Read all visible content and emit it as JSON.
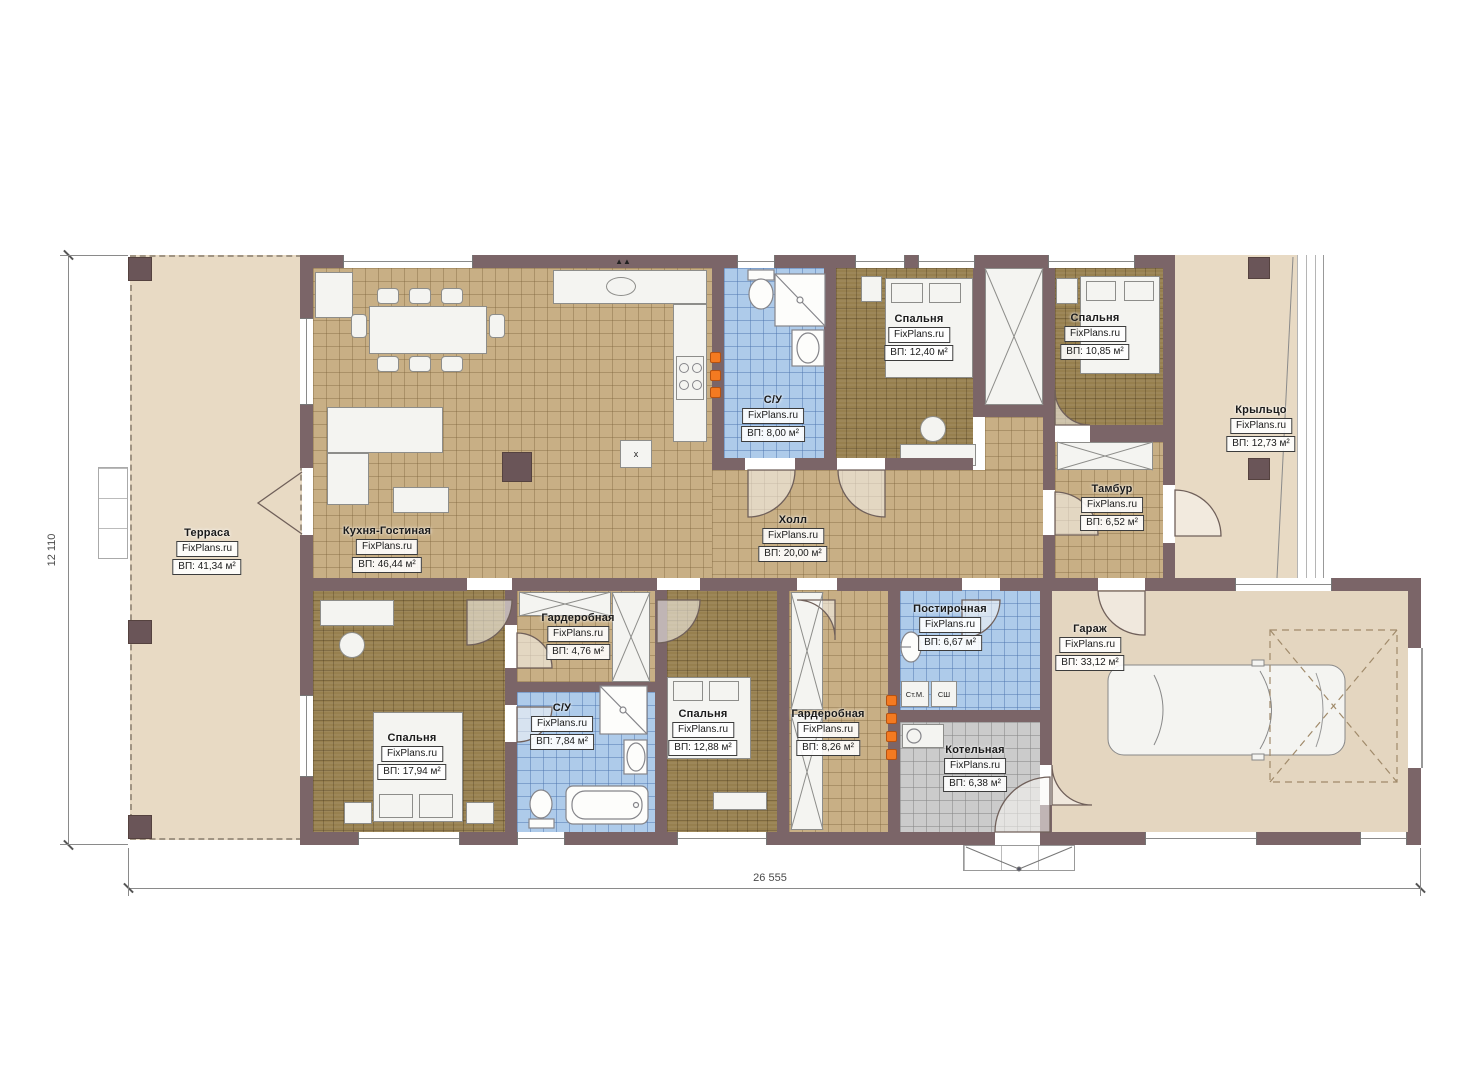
{
  "watermark": "FixPlans.ru",
  "dimensions": {
    "height": "12 110",
    "width": "26 555"
  },
  "rooms": [
    {
      "id": "terrace",
      "name": "Терраса",
      "area": "ВП: 41,34 м²"
    },
    {
      "id": "kitchen_living",
      "name": "Кухня-Гостиная",
      "area": "ВП: 46,44 м²"
    },
    {
      "id": "bathroom_1",
      "name": "С/У",
      "area": "ВП: 8,00 м²"
    },
    {
      "id": "bedroom_1",
      "name": "Спальня",
      "area": "ВП: 12,40 м²"
    },
    {
      "id": "bedroom_2",
      "name": "Спальня",
      "area": "ВП: 10,85 м²"
    },
    {
      "id": "porch",
      "name": "Крыльцо",
      "area": "ВП: 12,73 м²"
    },
    {
      "id": "vestibule",
      "name": "Тамбур",
      "area": "ВП: 6,52 м²"
    },
    {
      "id": "hall",
      "name": "Холл",
      "area": "ВП: 20,00 м²"
    },
    {
      "id": "wardrobe_1",
      "name": "Гардеробная",
      "area": "ВП: 4,76 м²"
    },
    {
      "id": "bathroom_2",
      "name": "С/У",
      "area": "ВП: 7,84 м²"
    },
    {
      "id": "bedroom_3",
      "name": "Спальня",
      "area": "ВП: 17,94 м²"
    },
    {
      "id": "bedroom_4",
      "name": "Спальня",
      "area": "ВП: 12,88 м²"
    },
    {
      "id": "wardrobe_2",
      "name": "Гардеробная",
      "area": "ВП: 8,26 м²"
    },
    {
      "id": "laundry",
      "name": "Постирочная",
      "area": "ВП: 6,67 м²"
    },
    {
      "id": "boiler",
      "name": "Котельная",
      "area": "ВП: 6,38 м²"
    },
    {
      "id": "garage",
      "name": "Гараж",
      "area": "ВП: 33,12 м²"
    }
  ],
  "appliance_labels": {
    "washing_machine": "Ст.М.",
    "drying_cabinet": "СШ",
    "kitchen_mark": "x",
    "vent_mark": "▲▲"
  }
}
